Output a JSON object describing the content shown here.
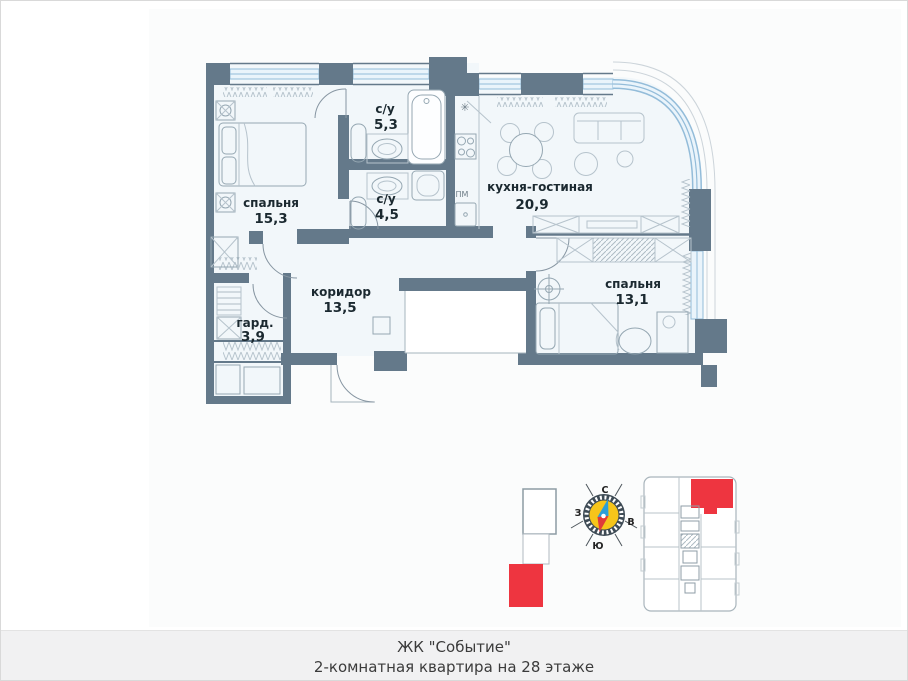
{
  "plan": {
    "rooms": [
      {
        "key": "bedroom-1",
        "name": "спальня",
        "area": "15,3"
      },
      {
        "key": "bathroom-1",
        "name": "с/у",
        "area": "5,3"
      },
      {
        "key": "bathroom-2",
        "name": "с/у",
        "area": "4,5"
      },
      {
        "key": "kitchen-living",
        "name": "кухня-гостиная",
        "area": "20,9"
      },
      {
        "key": "bedroom-2",
        "name": "спальня",
        "area": "13,1"
      },
      {
        "key": "corridor",
        "name": "коридор",
        "area": "13,5"
      },
      {
        "key": "wardrobe",
        "name": "гард.",
        "area": "3,9"
      }
    ],
    "labels": {
      "dishwasher": "ПМ"
    },
    "symbols": {
      "fridge": "✳"
    }
  },
  "compass": {
    "north": "С",
    "south": "Ю",
    "west": "З",
    "east": "В"
  },
  "caption": {
    "line1": "ЖК \"Событие\"",
    "line2": "2-комнатная квартира на 28 этаже"
  },
  "colors": {
    "wall": "#64798a",
    "floor": "#f2f7fa",
    "window": "#93bcd9",
    "accent_red": "#ee3540",
    "compass_yellow": "#f6c51a"
  }
}
